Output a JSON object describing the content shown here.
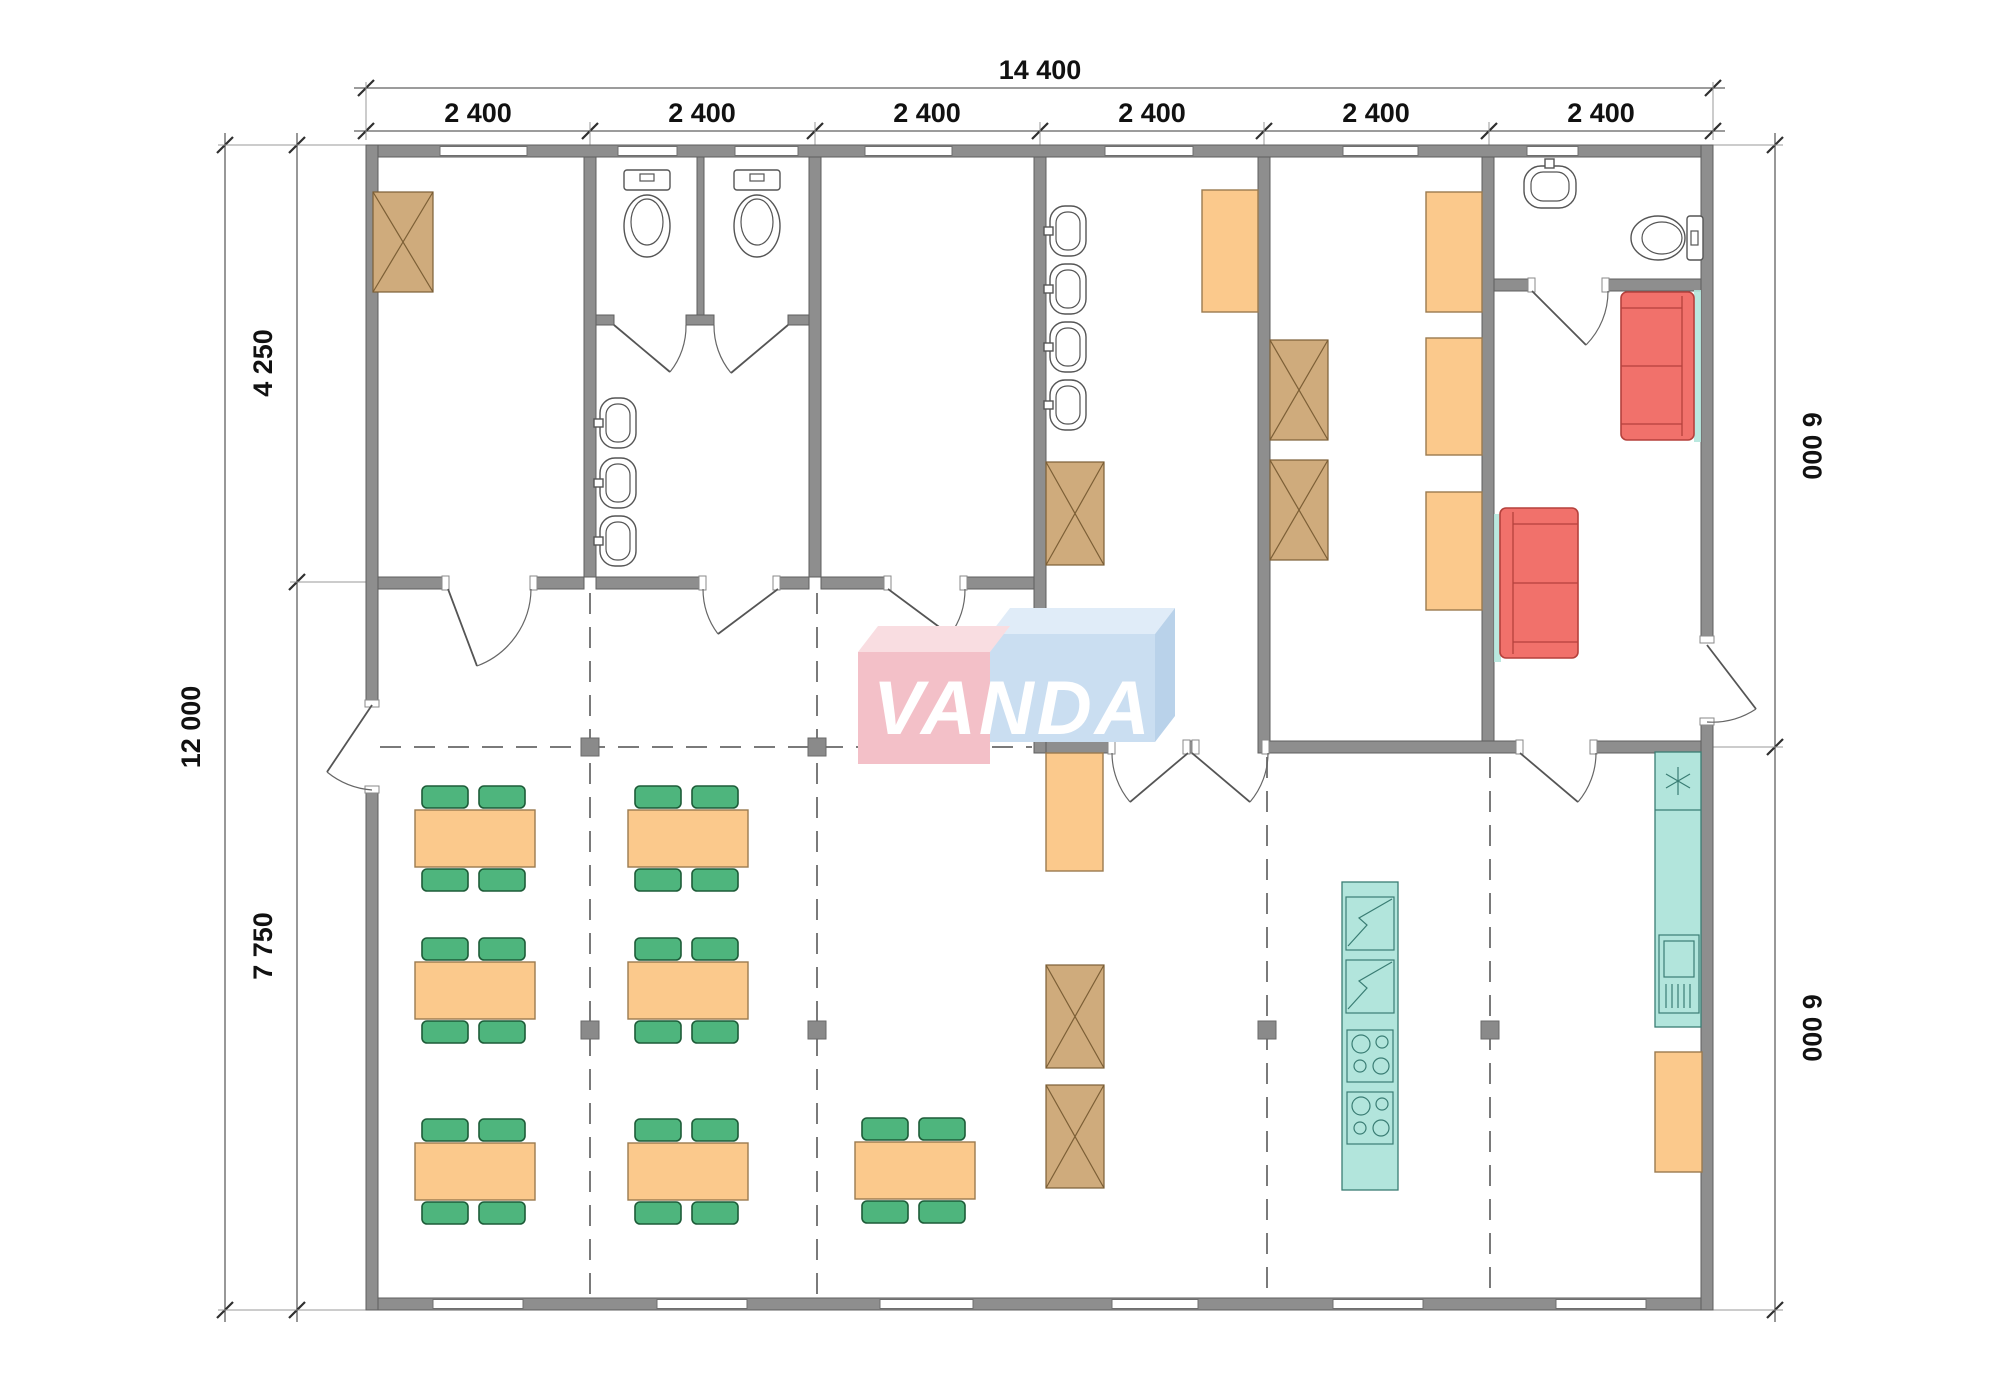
{
  "title": "VANDA modular building floor plan",
  "logo": {
    "text": "VANDA"
  },
  "dimensions": {
    "top_total": "14 400",
    "top_segments": [
      "2 400",
      "2 400",
      "2 400",
      "2 400",
      "2 400",
      "2 400"
    ],
    "left_total": "12 000",
    "left_upper": "4 250",
    "left_lower": "7 750",
    "right_upper": "6 000",
    "right_lower": "6 000"
  },
  "colors": {
    "wall": "#8e8e8e",
    "wall_outline": "#5f5f5f",
    "dash": "#7a7a7a",
    "marker": "#8a8a8a",
    "window": "#ffffff",
    "dim_text": "#111111",
    "table_orange": "#fbc98c",
    "table_stroke": "#9b7b4f",
    "chair_green": "#4eb57d",
    "chair_stroke": "#1d5c38",
    "wardrobe_tan": "#cfab7c",
    "wardrobe_stroke": "#7c5f36",
    "sofa_red": "#f1716b",
    "sofa_stroke": "#b5413c",
    "counter_teal": "#b2e5dc",
    "counter_stroke": "#3a7d74",
    "logo_pink": "#f3c0c8",
    "logo_pink_top": "#f9dde1",
    "logo_blue": "#cadef1",
    "logo_blue_top": "#e0ecf8",
    "logo_blue_side": "#b9d2ea",
    "logo_text": "#ffffff"
  }
}
